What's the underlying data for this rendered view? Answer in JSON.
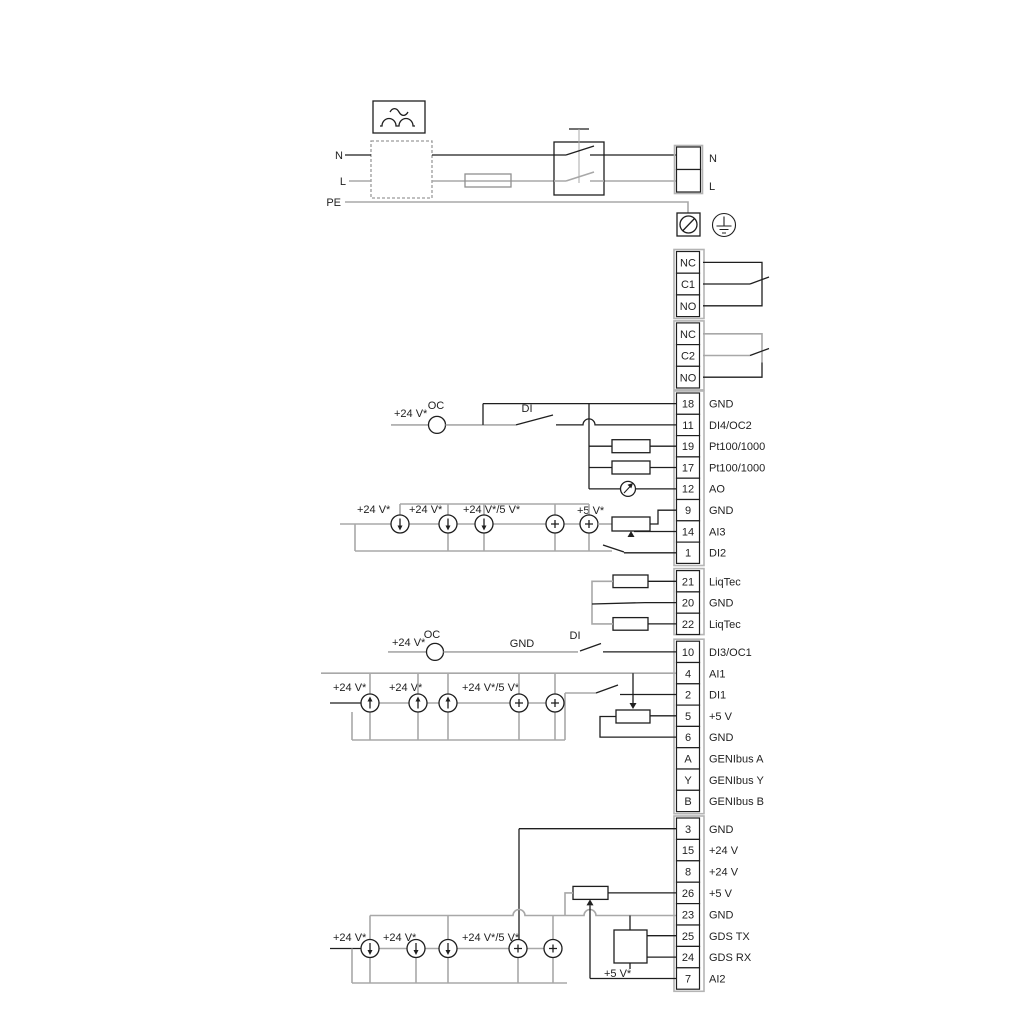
{
  "meta": {
    "description": "Electrical wiring diagram with mains input, two changeover relays and numbered control terminal strips (GENIbus, LiqTec, Pt100/1000, GDS).",
    "colors": {
      "wire_dark": "#1f1f1f",
      "wire_gray": "#a8a8a8",
      "background": "#ffffff"
    }
  },
  "power": {
    "n_left": "N",
    "l_left": "L",
    "pe": "PE",
    "n_right": "N",
    "l_right": "L"
  },
  "relay1": [
    "NC",
    "C1",
    "NO"
  ],
  "relay2": [
    "NC",
    "C2",
    "NO"
  ],
  "io1": [
    {
      "num": "18",
      "label": "GND"
    },
    {
      "num": "11",
      "label": "DI4/OC2"
    },
    {
      "num": "19",
      "label": "Pt100/1000"
    },
    {
      "num": "17",
      "label": "Pt100/1000"
    },
    {
      "num": "12",
      "label": "AO"
    },
    {
      "num": "9",
      "label": "GND"
    },
    {
      "num": "14",
      "label": "AI3"
    },
    {
      "num": "1",
      "label": "DI2"
    }
  ],
  "liqtec": [
    {
      "num": "21",
      "label": "LiqTec"
    },
    {
      "num": "20",
      "label": "GND"
    },
    {
      "num": "22",
      "label": "LiqTec"
    }
  ],
  "io2": [
    {
      "num": "10",
      "label": "DI3/OC1"
    },
    {
      "num": "4",
      "label": "AI1"
    },
    {
      "num": "2",
      "label": "DI1"
    },
    {
      "num": "5",
      "label": "+5 V"
    },
    {
      "num": "6",
      "label": "GND"
    },
    {
      "num": "A",
      "label": "GENIbus A"
    },
    {
      "num": "Y",
      "label": "GENIbus Y"
    },
    {
      "num": "B",
      "label": "GENIbus B"
    }
  ],
  "io3": [
    {
      "num": "3",
      "label": "GND"
    },
    {
      "num": "15",
      "label": "+24 V"
    },
    {
      "num": "8",
      "label": "+24 V"
    },
    {
      "num": "26",
      "label": "+5 V"
    },
    {
      "num": "23",
      "label": "GND"
    },
    {
      "num": "25",
      "label": "GDS TX"
    },
    {
      "num": "24",
      "label": "GDS RX"
    },
    {
      "num": "7",
      "label": "AI2"
    }
  ],
  "labels": {
    "di4_v24": "+24 V*",
    "di4_oc": "OC",
    "di4_di": "DI",
    "di3_v24": "+24 V*",
    "di3_oc": "OC",
    "di3_gnd": "GND",
    "di3_di": "DI",
    "bankA": {
      "l1": "+24 V*",
      "l2": "+24 V*",
      "l3": "+24 V*/5 V*",
      "l4": "+5 V*"
    },
    "bankB": {
      "l1": "+24 V*",
      "l2": "+24 V*",
      "l3": "+24 V*/5 V*"
    },
    "bankC": {
      "l1": "+24 V*",
      "l2": "+24 V*",
      "l3": "+24 V*/5 V*",
      "l5": "+5 V*"
    }
  }
}
